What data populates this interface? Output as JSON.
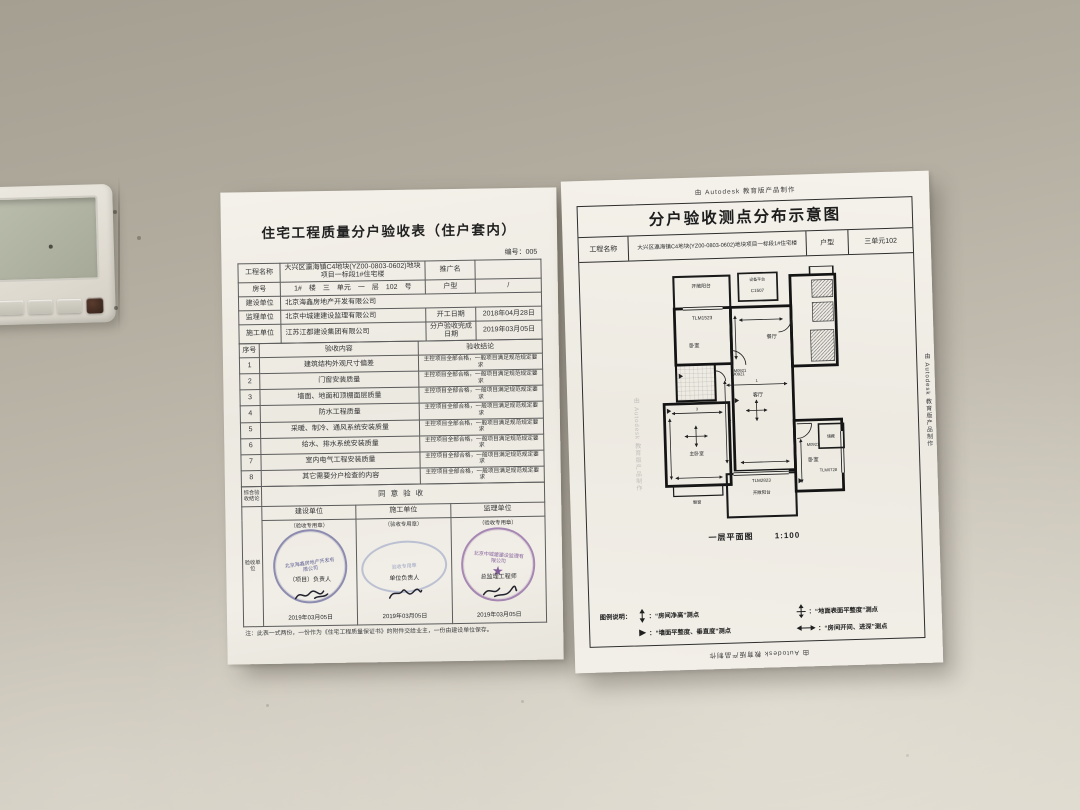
{
  "left_doc": {
    "title": "住宅工程质量分户验收表（住户套内）",
    "doc_no": "编号：005",
    "info": {
      "project_label": "工程名称",
      "project": "大兴区瀛海镇C4地块(YZ00-0803-0602)地块项目一标段1#住宅楼",
      "promo_label": "推广名",
      "promo": "",
      "room_label": "房号",
      "room": "1#　楼　三　单元　一　层　102　号",
      "type_label": "户型",
      "type": "/",
      "builder_label": "建设单位",
      "builder": "北京海鑫房地产开发有限公司",
      "supervisor_label": "监理单位",
      "supervisor": "北京中城建建设监理有限公司",
      "start_label": "开工日期",
      "start_date": "2018年04月28日",
      "contractor_label": "施工单位",
      "contractor": "江苏江都建设集团有限公司",
      "finish_label": "分户验收完成日期",
      "finish_date": "2019年03月05日"
    },
    "headers": {
      "no": "序号",
      "content": "验收内容",
      "result": "验收结论"
    },
    "items": [
      {
        "no": "1",
        "content": "建筑结构外观尺寸偏差",
        "result": "主控项目全部合格，一般项目满足规范规定要求"
      },
      {
        "no": "2",
        "content": "门窗安装质量",
        "result": "主控项目全部合格，一般项目满足规范规定要求"
      },
      {
        "no": "3",
        "content": "墙面、地面和顶棚面层质量",
        "result": "主控项目全部合格，一般项目满足规范规定要求"
      },
      {
        "no": "4",
        "content": "防水工程质量",
        "result": "主控项目全部合格，一般项目满足规范规定要求"
      },
      {
        "no": "5",
        "content": "采暖、制冷、通风系统安装质量",
        "result": "主控项目全部合格，一般项目满足规范规定要求"
      },
      {
        "no": "6",
        "content": "给水、排水系统安装质量",
        "result": "主控项目全部合格，一般项目满足规范规定要求"
      },
      {
        "no": "7",
        "content": "室内电气工程安装质量",
        "result": "主控项目全部合格，一般项目满足规范规定要求"
      },
      {
        "no": "8",
        "content": "其它需要分户检查的内容",
        "result": "主控项目全部合格，一般项目满足规范规定要求"
      }
    ],
    "summary_label": "综合验收结论",
    "summary": "同意验收",
    "unit_label": "验收单位",
    "columns": [
      {
        "header": "建设单位",
        "seal_note": "（验收专用章）",
        "role": "（项目）负责人",
        "stamp_text": "北京海鑫房地产开发有限公司",
        "date": "2019年03月05日"
      },
      {
        "header": "施工单位",
        "seal_note": "（验收专用章）",
        "role": "单位负责人",
        "stamp_text": "验收专用章",
        "date": "2019年03月05日"
      },
      {
        "header": "监理单位",
        "seal_note": "（验收专用章）",
        "role": "总监理工程师",
        "stamp_text": "北京中城建建设监理有限公司",
        "date": "2019年03月05日"
      }
    ],
    "note": "注：此表一式两份，一份作为《住宅工程质量保证书》的附件交给业主，一份由建设单位保存。"
  },
  "right_doc": {
    "watermark": "由 Autodesk 教育版产品制作",
    "title": "分户验收测点分布示意图",
    "project_label": "工程名称",
    "project": "大兴区瀛海镇C4地块(YZ00-0803-0602)地块项目一标段1#住宅楼",
    "type_label": "户型",
    "type": "三单元102",
    "plan_caption": "一层平面图",
    "plan_scale": "1:100",
    "legend_title": "图例说明：",
    "legend": [
      {
        "icon": "room-height-symbol",
        "text": "：“房间净高”测点"
      },
      {
        "icon": "wall-flatness-symbol",
        "text": "：“墙面平整度、垂直度”测点"
      },
      {
        "icon": "floor-flatness-symbol",
        "text": "：“地面表面平整度”测点"
      },
      {
        "icon": "room-span-symbol",
        "text": "：“房间开间、进深”测点"
      }
    ],
    "plan_labels": {
      "balcony_top": "开敞阳台",
      "win_tl": "TLM1523",
      "bed_tl": "卧室",
      "door_tl": "M0921",
      "equip": "设备平台",
      "win_top": "C1507",
      "dining": "餐厅",
      "living": "客厅",
      "door_mid": "M0921",
      "master": "主卧室",
      "bay": "飘窗",
      "win_bottom": "TLM2823",
      "balcony_bottom": "开敞阳台",
      "bed_r": "卧室",
      "door_r": "M0921",
      "win_r": "TLM0728",
      "storage": "储藏",
      "num1": "1",
      "num2": "2",
      "num3": "3"
    }
  }
}
